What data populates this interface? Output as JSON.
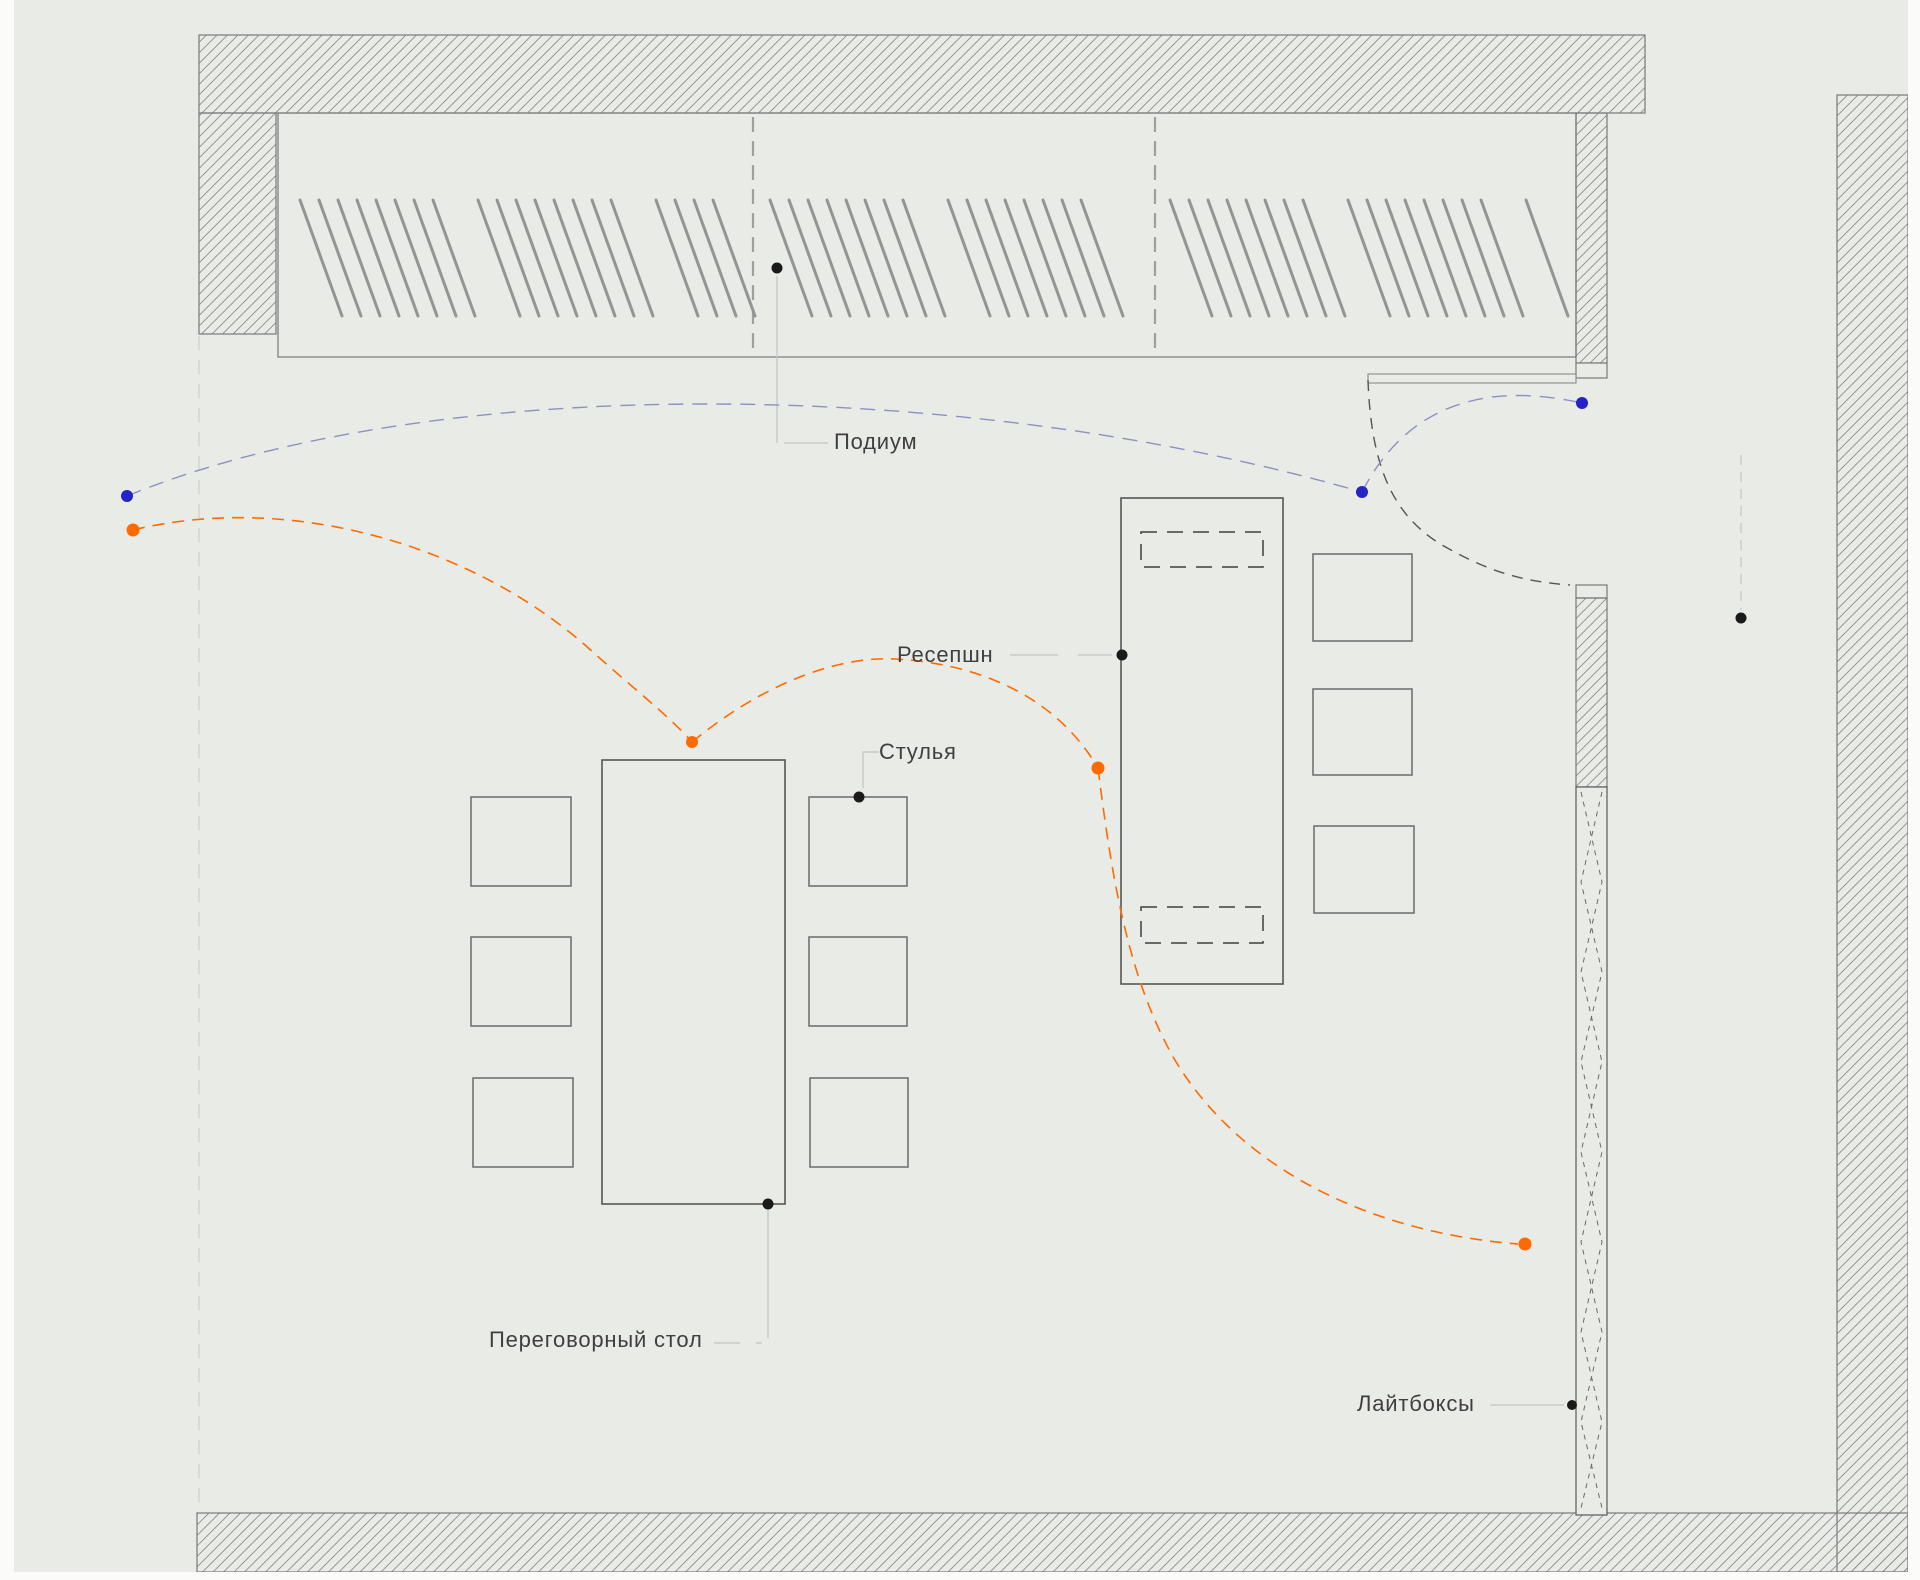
{
  "labels": {
    "podium": "Подиум",
    "reception": "Ресепшн",
    "chairs": "Стулья",
    "meeting_table": "Переговорный стол",
    "lightboxes": "Лайтбоксы"
  },
  "colors": {
    "background": "#e9ebe6",
    "wall_hatch": "#8e8e8e",
    "wall_outline": "#7a7a7a",
    "furniture_outline": "#565656",
    "chair_outline": "#6b6b6b",
    "leader_line": "#c4c4c4",
    "divider_dash": "#9f9f9f",
    "door_arc": "#555555",
    "marker_black": "#1a1a1a",
    "annotation_blue_dot": "#2323c8",
    "annotation_blue_dash": "#8a92c2",
    "annotation_orange": "#ff6a00",
    "text": "#3f3f3f"
  }
}
